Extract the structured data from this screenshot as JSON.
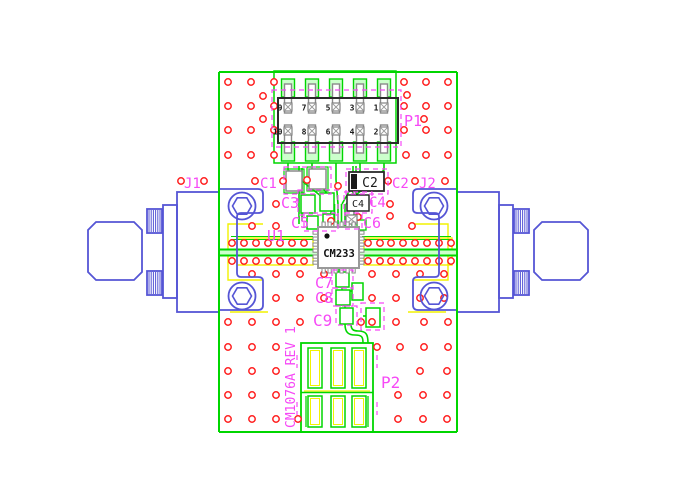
{
  "drawing": {
    "title": "PCB assembly drawing",
    "rev_text": "CM1076A REV 1",
    "ic_marking": "CM233",
    "labels": {
      "j1": "J1",
      "j2": "J2",
      "p1": "P1",
      "p2": "P2",
      "u1": "U1",
      "c1": "C1",
      "c2": "C2",
      "c3": "C3",
      "c4": "C4",
      "c5": "C5",
      "c6": "C6",
      "c7": "C7",
      "c8": "C8",
      "c9": "C9"
    },
    "chip_markings": {
      "c2": "C2",
      "c4": "C4"
    },
    "header_pins": {
      "top": [
        "9",
        "7",
        "5",
        "3",
        "1"
      ],
      "bottom": [
        "10",
        "8",
        "6",
        "4",
        "2"
      ]
    },
    "colors": {
      "trace_green": "#00d600",
      "pale_green": "#ccffcc",
      "via_red": "#ff2020",
      "silk_yellow": "#f2f200",
      "connector_blue": "#5555d5",
      "label_magenta": "#f649f6",
      "body_dark": "#2a2a2a",
      "pin_gray": "#8a8a8a"
    },
    "via_grid": {
      "radius": 3.2,
      "rows": [
        {
          "y": 82,
          "x": [
            228,
            251,
            274,
            404,
            426,
            448
          ]
        },
        {
          "y": 106,
          "x": [
            228,
            251,
            274,
            404,
            426,
            448
          ]
        },
        {
          "y": 130,
          "x": [
            228,
            251,
            274,
            404,
            426,
            448
          ]
        },
        {
          "y": 155,
          "x": [
            228,
            251,
            274,
            406,
            426,
            448
          ]
        },
        {
          "y": 181,
          "x": [
            181,
            204,
            255,
            283,
            388,
            415,
            445
          ]
        },
        {
          "y": 204,
          "x": [
            276,
            390
          ]
        },
        {
          "y": 226,
          "x": [
            252,
            276,
            412
          ]
        },
        {
          "y": 243,
          "x": [
            232,
            244,
            256,
            268,
            280,
            292,
            304,
            368,
            380,
            391,
            403,
            415,
            427,
            439,
            451
          ]
        },
        {
          "y": 261,
          "x": [
            232,
            244,
            256,
            268,
            280,
            292,
            304,
            368,
            380,
            391,
            403,
            415,
            427,
            439,
            451
          ]
        },
        {
          "y": 274,
          "x": [
            252,
            276,
            300,
            324,
            372,
            396,
            420,
            444
          ]
        },
        {
          "y": 298,
          "x": [
            276,
            300,
            324,
            372,
            396,
            420,
            444
          ]
        },
        {
          "y": 322,
          "x": [
            228,
            252,
            276,
            300,
            372,
            396,
            424,
            448
          ]
        },
        {
          "y": 347,
          "x": [
            228,
            252,
            276,
            377,
            400,
            424,
            448
          ]
        },
        {
          "y": 371,
          "x": [
            228,
            252,
            276,
            420,
            447
          ]
        },
        {
          "y": 395,
          "x": [
            228,
            252,
            276,
            398,
            423,
            447
          ]
        },
        {
          "y": 419,
          "x": [
            228,
            252,
            276,
            298,
            398,
            423,
            447
          ]
        }
      ],
      "extra": [
        [
          307,
          180
        ],
        [
          338,
          186
        ],
        [
          331,
          221
        ],
        [
          358,
          217
        ],
        [
          390,
          216
        ],
        [
          361,
          322
        ],
        [
          263,
          96
        ],
        [
          263,
          119
        ],
        [
          407,
          95
        ],
        [
          424,
          119
        ]
      ]
    },
    "header_columns_x": [
      288,
      312,
      336,
      360,
      384
    ]
  }
}
